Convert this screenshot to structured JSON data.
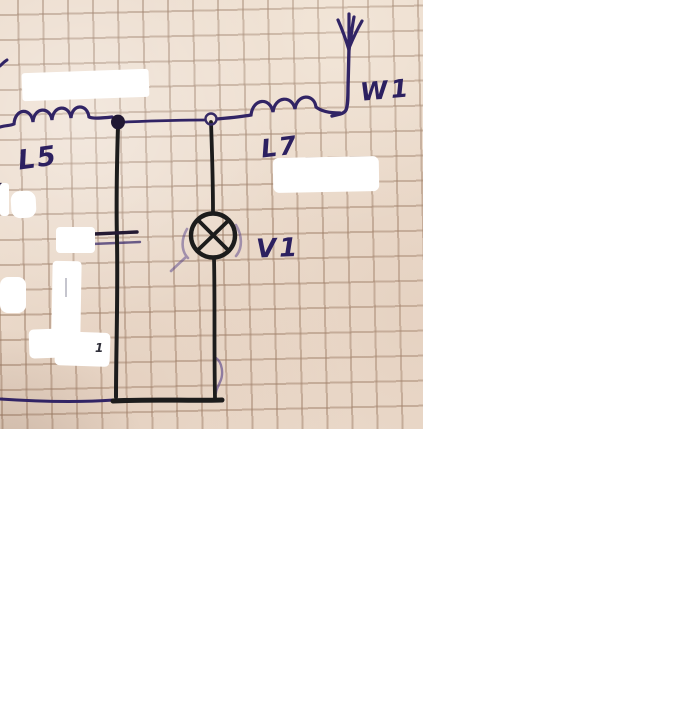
{
  "window": {
    "width": 680,
    "height": 705,
    "background": "#ffffff"
  },
  "photo": {
    "kind": "hand-drawn radio circuit schematic on squared graph paper",
    "paper_color": "#ecdccd",
    "grid_color": "#9d7f69",
    "ink_blue": "#312465",
    "ink_black": "#1c1c1c",
    "label_color": "#2c2060",
    "labels": {
      "antenna": "W1",
      "inductor_left": "L5",
      "inductor_right": "L7",
      "lamp": "V1",
      "leftover_fragment": "1"
    },
    "components": [
      {
        "type": "antenna",
        "label": "W1"
      },
      {
        "type": "inductor",
        "label": "L5"
      },
      {
        "type": "inductor",
        "label": "L7"
      },
      {
        "type": "incandescent-lamp",
        "label": "V1"
      },
      {
        "type": "capacitor",
        "label": ""
      },
      {
        "type": "junction-dot",
        "label": ""
      },
      {
        "type": "terminal-node",
        "label": ""
      }
    ],
    "whiteout_patch_count": 8
  }
}
